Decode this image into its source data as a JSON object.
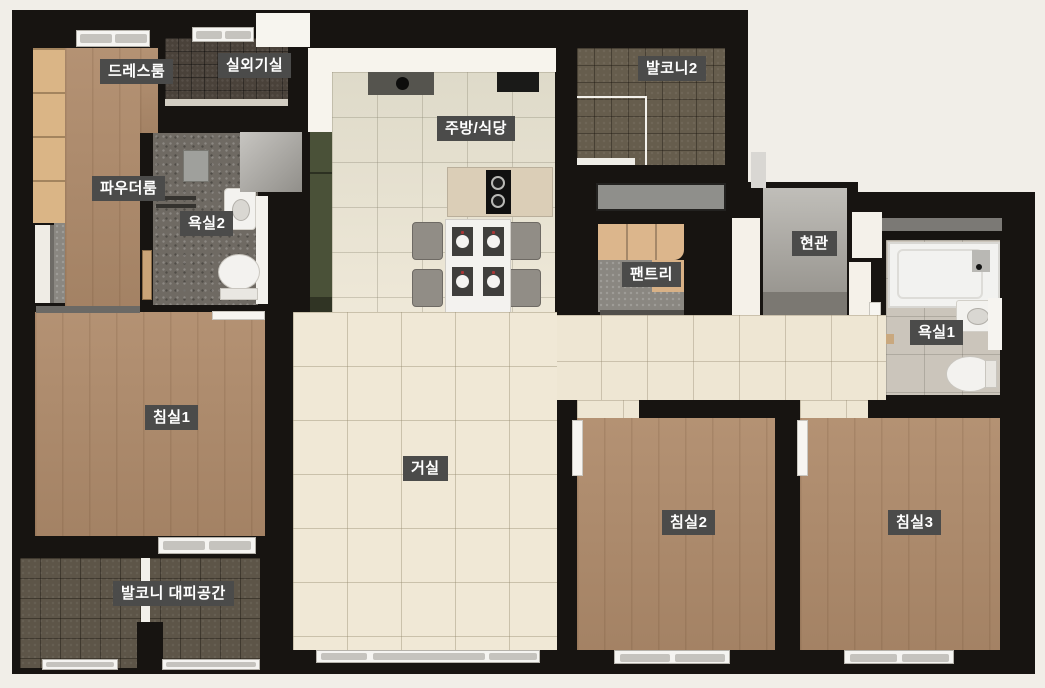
{
  "floorplan": {
    "type": "apartment-unit-floor-plan",
    "rooms": [
      {
        "id": "dressroom",
        "label": "드레스룸"
      },
      {
        "id": "outdoor-unit-room",
        "label": "실외기실"
      },
      {
        "id": "powder-room",
        "label": "파우더룸"
      },
      {
        "id": "bathroom2",
        "label": "욕실2"
      },
      {
        "id": "kitchen-dining",
        "label": "주방/식당"
      },
      {
        "id": "balcony2",
        "label": "발코니2"
      },
      {
        "id": "pantry",
        "label": "팬트리"
      },
      {
        "id": "entrance",
        "label": "현관"
      },
      {
        "id": "bathroom1",
        "label": "욕실1"
      },
      {
        "id": "bedroom1",
        "label": "침실1"
      },
      {
        "id": "living-room",
        "label": "거실"
      },
      {
        "id": "bedroom2",
        "label": "침실2"
      },
      {
        "id": "bedroom3",
        "label": "침실3"
      },
      {
        "id": "balcony-refuge",
        "label": "발코니 대피공간"
      }
    ],
    "colors": {
      "background": "#f1eee8",
      "wall": "#171411",
      "label_background": "#4b4b4a",
      "label_text": "#ffffff",
      "wood_floor": "#b08c6c",
      "living_tile": "#f0e8d6",
      "balcony_tile": "#5d5548",
      "bathroom_tile_dark": "#6f6a63",
      "bathroom_tile_light": "#cbc5bb",
      "cabinet_green": "#4a5138",
      "cabinet_wood": "#dab586"
    }
  }
}
